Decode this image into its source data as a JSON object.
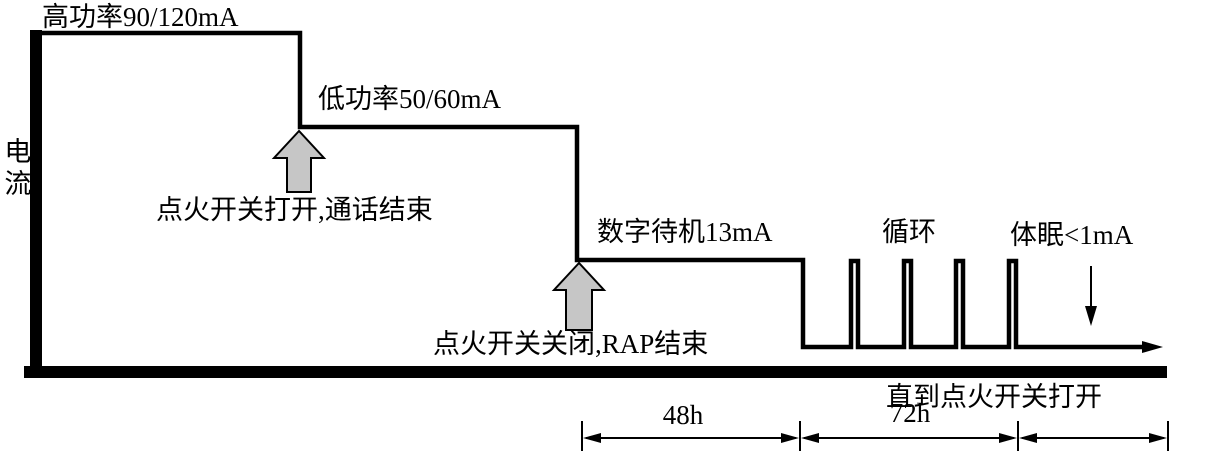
{
  "diagram": {
    "y_axis_label": "电流",
    "labels": {
      "high_power": "高功率90/120mA",
      "low_power": "低功率50/60mA",
      "standby": "数字待机13mA",
      "cycle": "循环",
      "sleep": "体眠<1mA"
    },
    "events": {
      "ignition_on_call_end": "点火开关打开,通话结束",
      "ignition_off_rap_end": "点火开关关闭,RAP结束",
      "until_ignition_on": "直到点火开关打开"
    },
    "durations": {
      "standby_period": "48h",
      "cycle_period": "72h"
    },
    "colors": {
      "line": "#000000",
      "arrow_fill": "#c6c6c6",
      "background": "#ffffff"
    }
  },
  "chart_data": {
    "type": "line",
    "subtype": "step-timing-waveform",
    "ylabel": "电流",
    "xlabel": "",
    "grid": false,
    "segments": [
      {
        "stage": "高功率",
        "current": "90/120mA",
        "event_at_start": ""
      },
      {
        "stage": "低功率",
        "current": "50/60mA",
        "event_at_start": "点火开关打开,通话结束"
      },
      {
        "stage": "数字待机",
        "current": "13mA",
        "duration": "48h",
        "event_at_start": "点火开关关闭,RAP结束"
      },
      {
        "stage": "循环",
        "current": "pulses between 13mA and low level",
        "duration": "72h",
        "pulse_count": 4
      },
      {
        "stage": "体眠",
        "current": "<1mA",
        "duration": "直到点火开关打开"
      }
    ]
  }
}
